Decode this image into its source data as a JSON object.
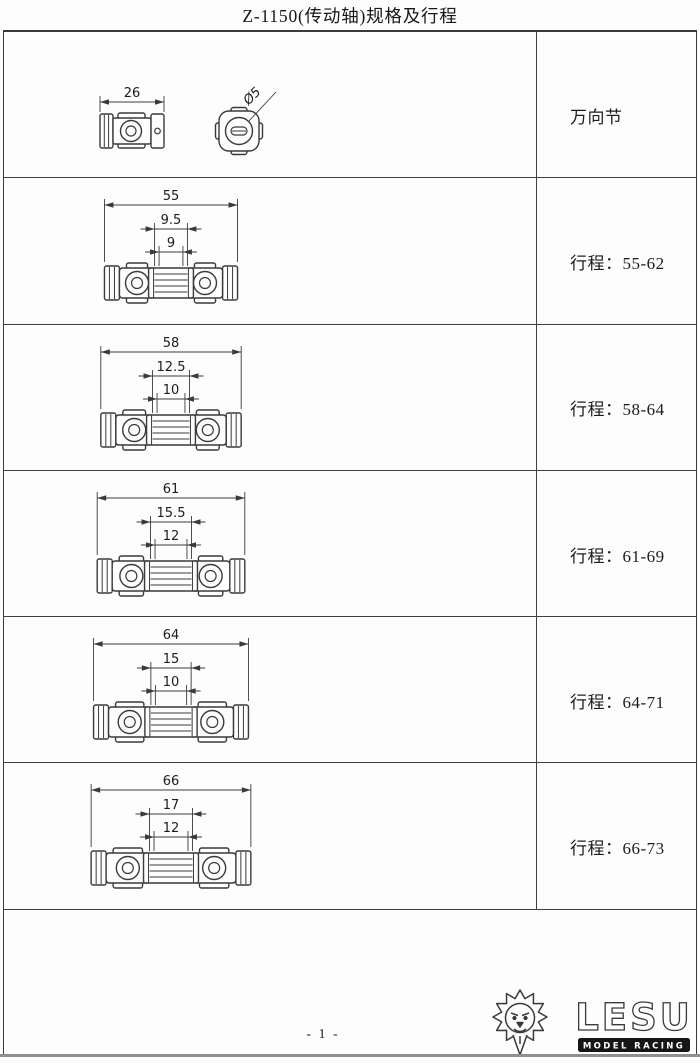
{
  "title": "Z-1150(传动轴)规格及行程",
  "table": {
    "rows": [
      {
        "type": "joint",
        "label": "万向节",
        "dims": {
          "overall": "26",
          "diameter": "Ø5"
        }
      },
      {
        "type": "shaft",
        "label": "行程：55-62",
        "dims": {
          "overall": "55",
          "mid": "9.5",
          "inner": "9"
        }
      },
      {
        "type": "shaft",
        "label": "行程：58-64",
        "dims": {
          "overall": "58",
          "mid": "12.5",
          "inner": "10"
        }
      },
      {
        "type": "shaft",
        "label": "行程：61-69",
        "dims": {
          "overall": "61",
          "mid": "15.5",
          "inner": "12"
        }
      },
      {
        "type": "shaft",
        "label": "行程：64-71",
        "dims": {
          "overall": "64",
          "mid": "15",
          "inner": "10"
        }
      },
      {
        "type": "shaft",
        "label": "行程：66-73",
        "dims": {
          "overall": "66",
          "mid": "17",
          "inner": "12"
        }
      }
    ]
  },
  "footer": {
    "page_number": "- 1 -",
    "brand": "LESU",
    "brand_subtitle": "MODEL RACING",
    "logo": "lion-head"
  },
  "colors": {
    "line": "#3a3a3a",
    "text": "#1c1c1c",
    "logo_box": "#161616",
    "page_edge": "#8f8f8f"
  }
}
